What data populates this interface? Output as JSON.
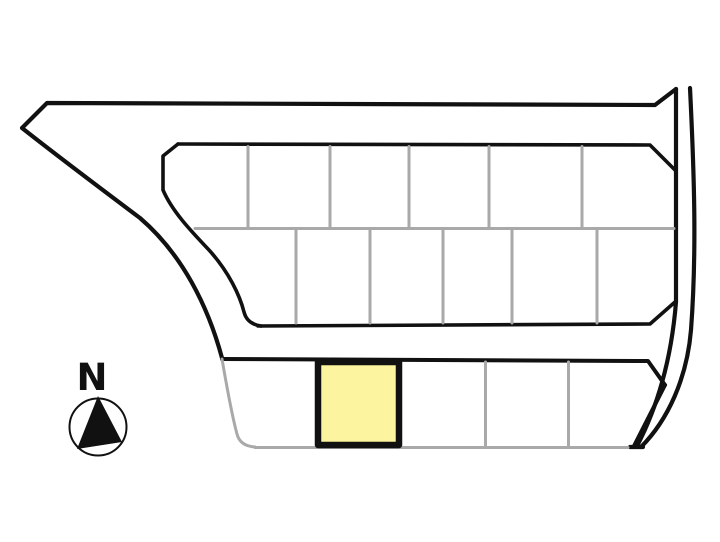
{
  "compass": {
    "label": "N"
  },
  "colors": {
    "background": "#ffffff",
    "boundary_line": "#111111",
    "lot_line": "#a9a9a9",
    "highlight_fill": "#fcf49e",
    "highlight_border": "#111111"
  },
  "site_plan": {
    "description": "subdivision lot layout with perimeter road",
    "rows": [
      {
        "name": "north-row",
        "lot_count": 6,
        "highlighted": false
      },
      {
        "name": "middle-row",
        "lot_count": 6,
        "highlighted": false
      },
      {
        "name": "south-row",
        "lot_count": 5,
        "highlighted": true,
        "highlighted_lot_position": 2
      }
    ],
    "highlighted_lots_total": 1
  }
}
